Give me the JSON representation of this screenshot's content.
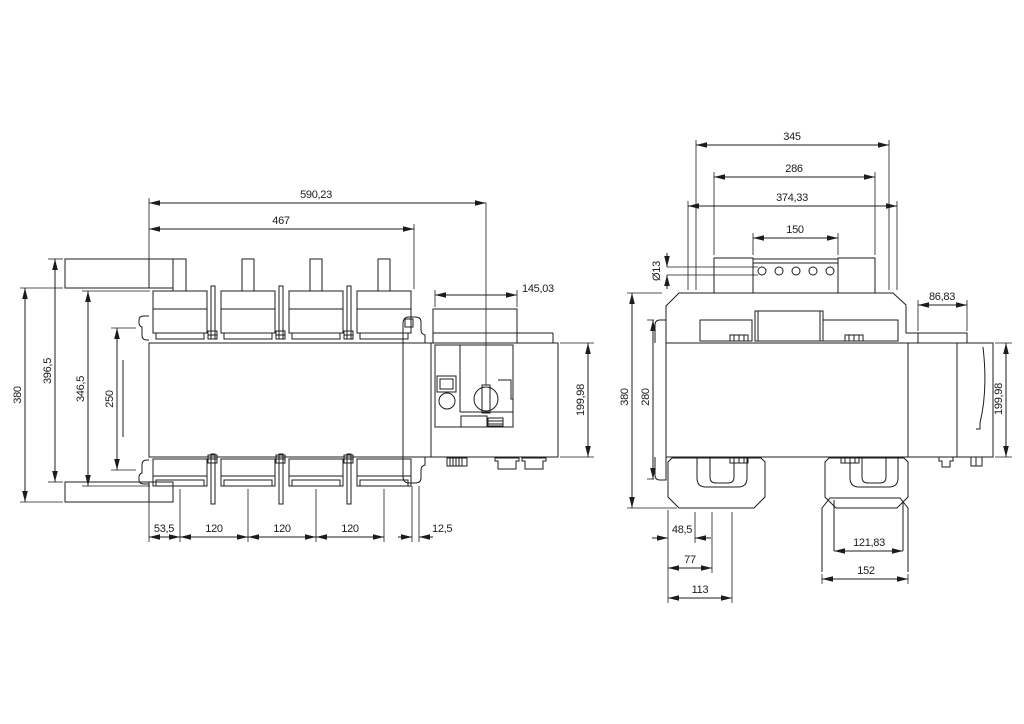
{
  "front_view": {
    "dims": {
      "overall_width": "590,23",
      "terminal_span": "467",
      "drive_width": "145,03",
      "body_depth": "199,98",
      "plate_height": "380",
      "overall_height": "396,5",
      "terminal_height": "346,5",
      "mount_spacing": "250",
      "first_pole_offset": "53,5",
      "pole_pitch": "120",
      "edge_offset": "12,5"
    }
  },
  "side_view": {
    "dims": {
      "bracket_span": "345",
      "bridge_width": "286",
      "top_width": "374,33",
      "busbar_width": "150",
      "hole_diameter": "Ø13",
      "drive_depth": "86,83",
      "overall_height": "380",
      "flange_span": "280",
      "body_depth": "199,98",
      "foot_offset_a": "48,5",
      "foot_offset_b": "77",
      "foot_offset_c": "113",
      "base_inner_width": "121,83",
      "base_width": "152"
    }
  }
}
